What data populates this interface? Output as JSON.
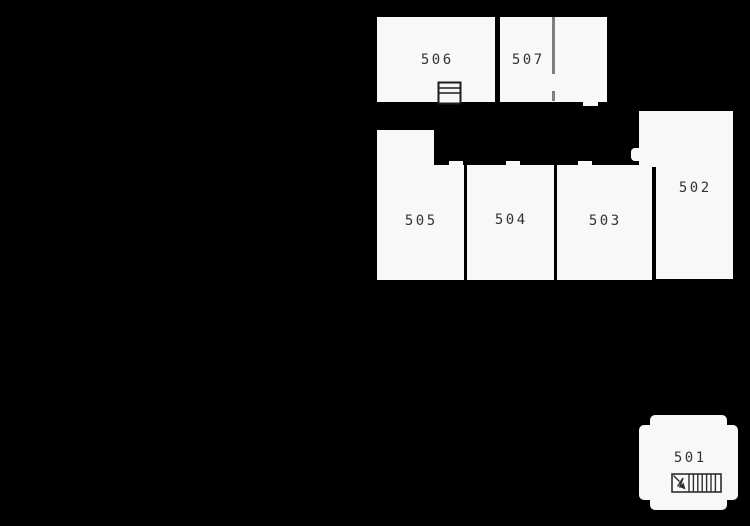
{
  "floorplan": {
    "background_color": "#000000",
    "room_fill": "#f8f8f8",
    "partition_color": "#7f7f7f",
    "symbol_stroke": "#2e2e2e",
    "label_color": "#333333",
    "rooms": [
      {
        "id": "501",
        "label": "501",
        "features": [
          "stairs-icon"
        ]
      },
      {
        "id": "502",
        "label": "502",
        "features": [
          "door-opening"
        ]
      },
      {
        "id": "503",
        "label": "503",
        "features": [
          "door-opening"
        ]
      },
      {
        "id": "504",
        "label": "504",
        "features": [
          "door-opening"
        ]
      },
      {
        "id": "505",
        "label": "505",
        "features": [
          "door-opening"
        ]
      },
      {
        "id": "506",
        "label": "506",
        "features": [
          "cabinet-icon"
        ]
      },
      {
        "id": "507",
        "label": "507",
        "features": [
          "partition-wall",
          "door-opening"
        ]
      }
    ]
  }
}
